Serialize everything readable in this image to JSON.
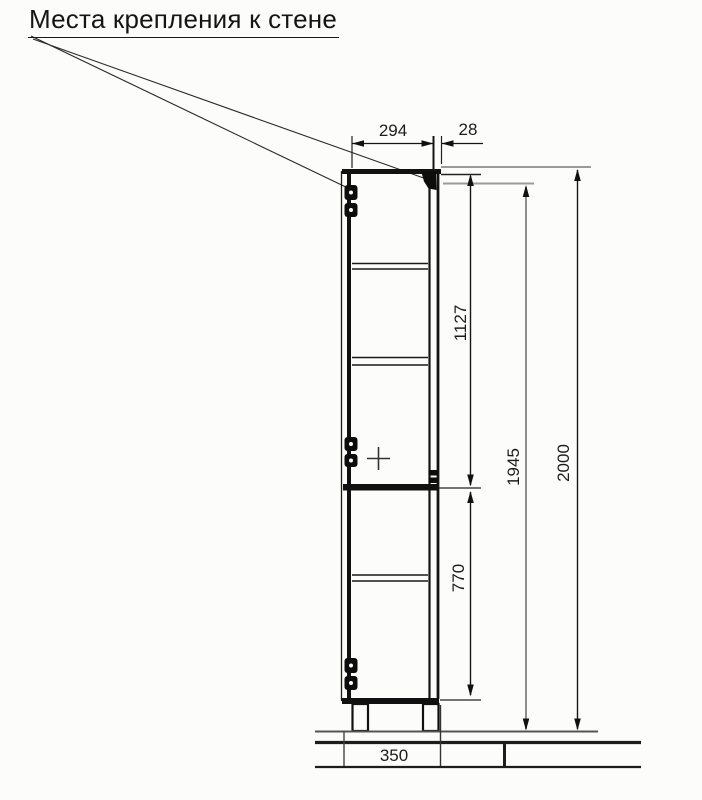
{
  "title": "Места крепления к стене",
  "dimensions": {
    "cabinet_depth": "294",
    "back_offset": "28",
    "upper_section_height": "1127",
    "mounting_height": "1945",
    "total_height": "2000",
    "lower_section_height": "770",
    "base_depth": "350"
  },
  "colors": {
    "line": "#1a1a1a",
    "dim_secondary": "#8e8e8e",
    "background": "#fcfcfb"
  }
}
